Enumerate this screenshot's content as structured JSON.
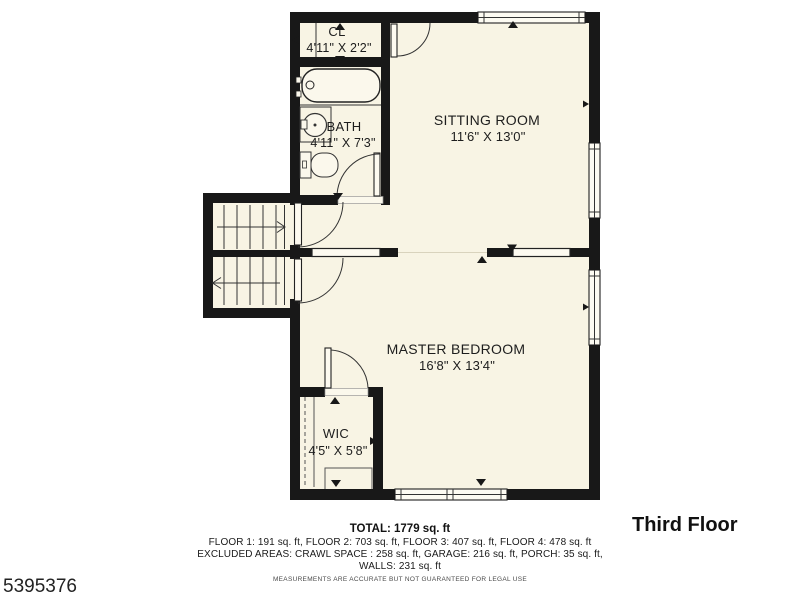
{
  "floor_plan": {
    "title": "Third Floor",
    "listing_id": "5395376",
    "rooms": [
      {
        "name": "CL",
        "dimensions": "4'11\" X 2'2\""
      },
      {
        "name": "BATH",
        "dimensions": "4'11\" X 7'3\""
      },
      {
        "name": "SITTING ROOM",
        "dimensions": "11'6\" X 13'0\""
      },
      {
        "name": "MASTER BEDROOM",
        "dimensions": "16'8\" X 13'4\""
      },
      {
        "name": "WIC",
        "dimensions": "4'5\" X 5'8\""
      }
    ],
    "summary": {
      "total": "TOTAL: 1779 sq. ft",
      "floors": "FLOOR 1: 191 sq. ft, FLOOR 2: 703 sq. ft, FLOOR 3: 407 sq. ft, FLOOR 4: 478 sq. ft",
      "excluded": "EXCLUDED AREAS: CRAWL SPACE : 258 sq. ft, GARAGE: 216 sq. ft, PORCH: 35 sq. ft,",
      "walls": "WALLS: 231 sq. ft",
      "disclaimer": "MEASUREMENTS ARE ACCURATE BUT NOT GUARANTEED FOR LEGAL USE"
    },
    "colors": {
      "background": "#ffffff",
      "floor_fill": "#f8f4e4",
      "wall": "#181818"
    }
  }
}
